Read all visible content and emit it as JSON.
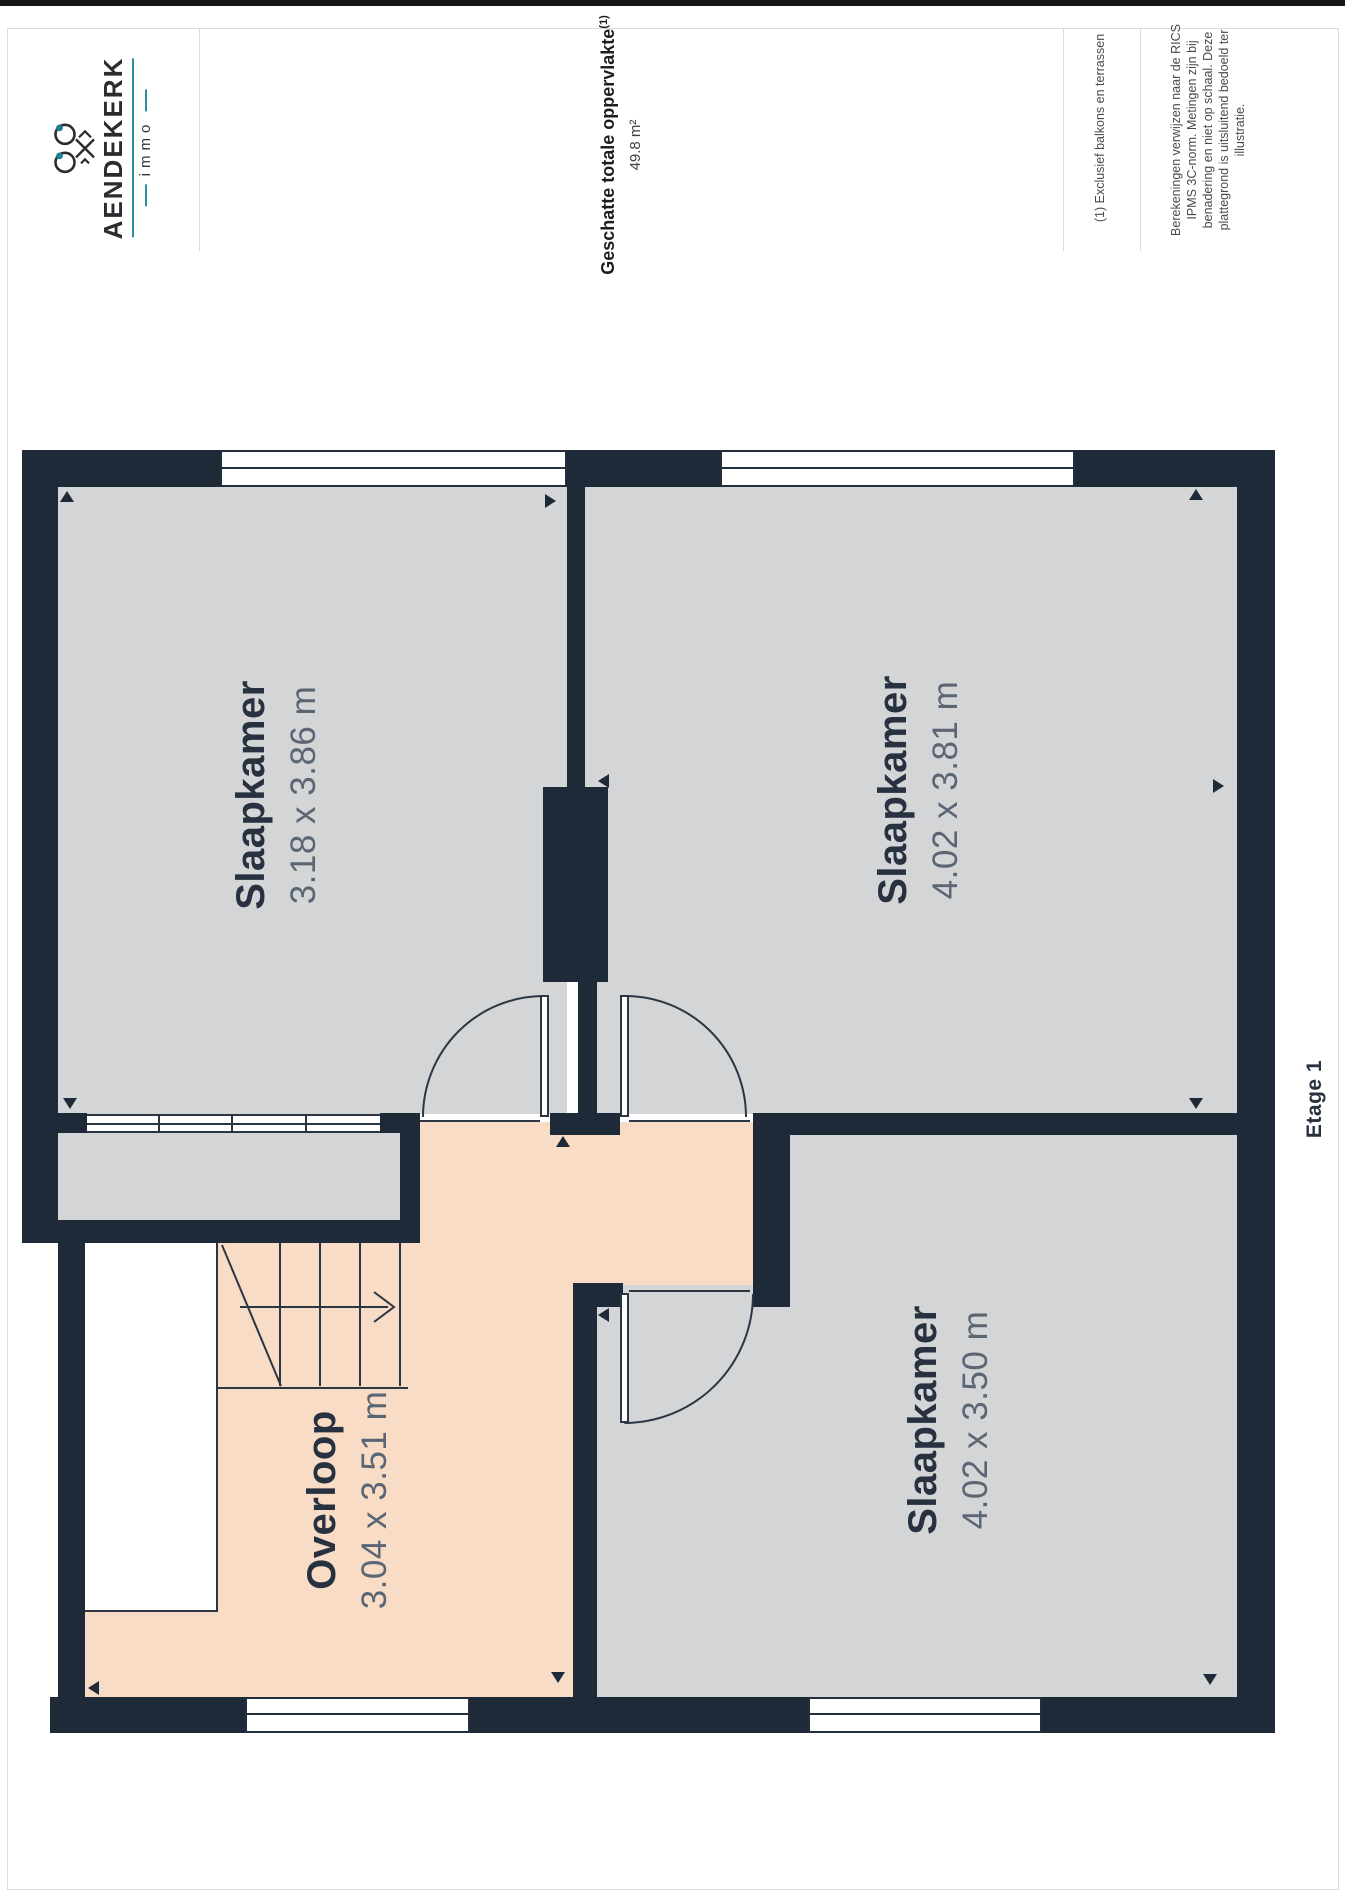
{
  "brand": {
    "name": "AENDEKERK",
    "sub": "immo",
    "accent_teal": "#1d7f93"
  },
  "header": {
    "title": "Geschatte totale oppervlakte",
    "title_sup": "(1)",
    "total_area": "49.8 m²",
    "note1": "(1) Exclusief balkons en terrassen",
    "note2_lines": [
      "Berekeningen verwijzen naar de RICS",
      "IPMS 3C-norm. Metingen zijn bij",
      "benadering en niet op schaal. Deze",
      "plattegrond is uitsluitend bedoeld ter",
      "illustratie."
    ]
  },
  "plan": {
    "floor_label": "Etage 1",
    "rooms": [
      {
        "name": "Slaapkamer",
        "dims": "3.18 x 3.86 m"
      },
      {
        "name": "Slaapkamer",
        "dims": "4.02 x 3.81 m"
      },
      {
        "name": "Slaapkamer",
        "dims": "4.02 x 3.50 m"
      },
      {
        "name": "Overloop",
        "dims": "3.04 x 3.51 m"
      }
    ],
    "colors": {
      "wall": "#1f2a38",
      "room_fill": "#d4d5d7",
      "hall_fill": "#f8dcc6",
      "label": "#27313f",
      "dims": "#5b6675"
    }
  }
}
